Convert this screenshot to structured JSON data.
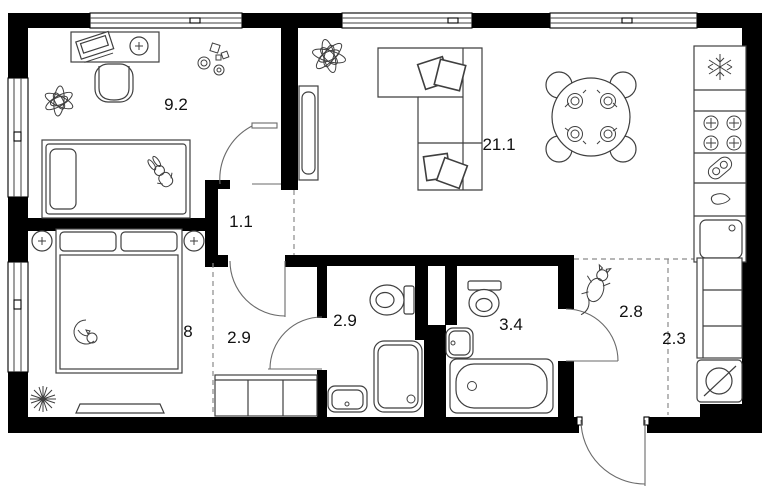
{
  "plan": {
    "type": "apartment-floor-plan",
    "units": "square-meters-implied",
    "colors": {
      "wall": "#000000",
      "line": "#3f3f3f",
      "door": "#6a6a6a",
      "dash": "#8a8a8a",
      "label": "#111111",
      "background": "#ffffff"
    },
    "rooms": {
      "children_bedroom": {
        "area": "9.2"
      },
      "living_kitchen": {
        "area": "21.1"
      },
      "inner_hall": {
        "area": "1.1"
      },
      "bedroom": {
        "area": "8"
      },
      "hallway": {
        "area": "2.9"
      },
      "shower_room": {
        "area": "2.9"
      },
      "bathroom": {
        "area": "3.4"
      },
      "entry_hall": {
        "area": "2.8"
      },
      "corridor": {
        "area": "2.3"
      }
    },
    "fixtures": [
      "fridge-icon",
      "hob-icon",
      "kitchen-sink",
      "dining-table",
      "sofa",
      "tv",
      "single-bed",
      "double-bed",
      "desk",
      "chair",
      "toilet",
      "shower-cabin",
      "bathtub",
      "washbasin",
      "washing-machine-icon",
      "wardrobe",
      "closet",
      "plant-icon",
      "cat-icon",
      "bunny-icon",
      "entrance-door"
    ]
  }
}
